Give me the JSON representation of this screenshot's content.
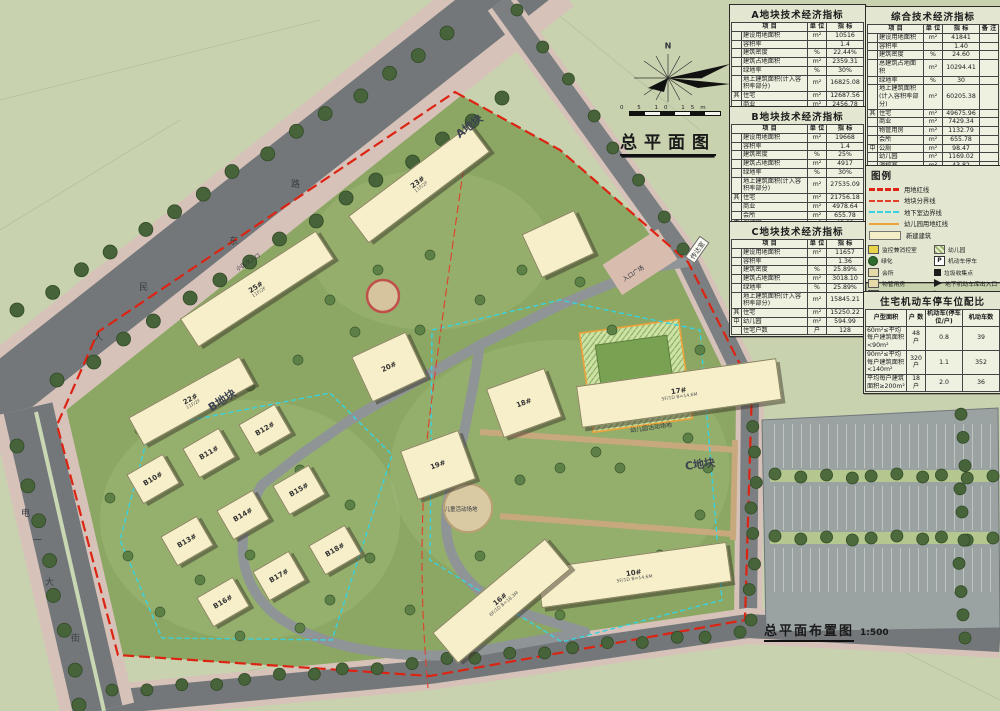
{
  "page": {
    "plan_title": "总平面图",
    "bottom_title": "总平面布置图",
    "bottom_scale": "1:500",
    "north_label": "N",
    "scale_bar_numbers": "0 5 10 15m"
  },
  "tables": {
    "a": {
      "title": "A地块技术经济指标",
      "header": [
        "项  目",
        "单 位",
        "指  标"
      ],
      "rows": [
        [
          "",
          "建设用地面积",
          "m²",
          "10516"
        ],
        [
          "",
          "容积率",
          "",
          "1.4"
        ],
        [
          "",
          "建筑密度",
          "%",
          "22.44%"
        ],
        [
          "",
          "建筑占地面积",
          "m²",
          "2359.31"
        ],
        [
          "",
          "绿地率",
          "%",
          "30%"
        ],
        [
          "",
          "地上建筑面积(计入容积率部分)",
          "m²",
          "16825.08"
        ],
        [
          "其",
          "住宅",
          "m²",
          "12687.56"
        ],
        [
          "",
          "商业",
          "m²",
          "2456.78"
        ],
        [
          "",
          "物管用房",
          "m²",
          "1132.79"
        ],
        [
          "中",
          "幼儿园",
          "m²",
          "574.03"
        ],
        [
          "",
          "住宅户数",
          "户",
          "108"
        ]
      ]
    },
    "b": {
      "title": "B地块技术经济指标",
      "header": [
        "项  目",
        "单 位",
        "指  标"
      ],
      "rows": [
        [
          "",
          "建设用地面积",
          "m²",
          "19668"
        ],
        [
          "",
          "容积率",
          "",
          "1.4"
        ],
        [
          "",
          "建筑密度",
          "%",
          "25%"
        ],
        [
          "",
          "建筑占地面积",
          "m²",
          "4917"
        ],
        [
          "",
          "绿地率",
          "%",
          "30%"
        ],
        [
          "",
          "地上建筑面积(计入容积率部分)",
          "m²",
          "27535.09"
        ],
        [
          "其",
          "住宅",
          "m²",
          "21756.18"
        ],
        [
          "",
          "商业",
          "m²",
          "4978.64"
        ],
        [
          "",
          "会所",
          "m²",
          "655.78"
        ],
        [
          "中",
          "消控室",
          "m²",
          "43.82"
        ],
        [
          "",
          "公厕",
          "m²",
          "98.67"
        ],
        [
          "",
          "住宅户数",
          "户",
          "150"
        ]
      ]
    },
    "c": {
      "title": "C地块技术经济指标",
      "header": [
        "项  目",
        "单 位",
        "指  标"
      ],
      "rows": [
        [
          "",
          "建设用地面积",
          "m²",
          "11657"
        ],
        [
          "",
          "容积率",
          "",
          "1.36"
        ],
        [
          "",
          "建筑密度",
          "%",
          "25.89%"
        ],
        [
          "",
          "建筑占地面积",
          "m²",
          "3018.10"
        ],
        [
          "",
          "绿地率",
          "%",
          "25.89%"
        ],
        [
          "",
          "地上建筑面积(计入容积率部分)",
          "m²",
          "15845.21"
        ],
        [
          "其",
          "住宅",
          "m²",
          "15250.22"
        ],
        [
          "中",
          "幼儿园",
          "m²",
          "594.99"
        ],
        [
          "",
          "住宅户数",
          "户",
          "128"
        ]
      ]
    },
    "comp": {
      "title": "综合技术经济指标",
      "header": [
        "项  目",
        "单 位",
        "指  标",
        "备 注"
      ],
      "rows": [
        [
          "",
          "建设用地面积",
          "m²",
          "41841",
          ""
        ],
        [
          "",
          "容积率",
          "",
          "1.40",
          ""
        ],
        [
          "",
          "建筑密度",
          "%",
          "24.60",
          ""
        ],
        [
          "",
          "总建筑占地面积",
          "m²",
          "10294.41",
          ""
        ],
        [
          "",
          "绿地率",
          "%",
          "30",
          ""
        ],
        [
          "",
          "地上建筑面积(计入容积率部分)",
          "m²",
          "60205.38",
          ""
        ],
        [
          "其",
          "住宅",
          "m²",
          "49675.96",
          ""
        ],
        [
          "",
          "商业",
          "m²",
          "7429.34",
          ""
        ],
        [
          "",
          "物管用房",
          "m²",
          "1132.79",
          ""
        ],
        [
          "",
          "会所",
          "m²",
          "655.78",
          ""
        ],
        [
          "中",
          "公厕",
          "m²",
          "98.47",
          ""
        ],
        [
          "",
          "幼儿园",
          "m²",
          "1169.02",
          ""
        ],
        [
          "",
          "消控室",
          "m²",
          "43.82",
          ""
        ],
        [
          "",
          "住宅户数",
          "户",
          "386",
          ""
        ],
        [
          "",
          "地下室(其中人防建筑面积10581.66m²)",
          "m²",
          "41853.32",
          ""
        ],
        [
          "",
          "机动车停车位",
          "个",
          "720",
          ""
        ],
        [
          "其",
          "地上停车位",
          "个",
          "30",
          ""
        ],
        [
          "中",
          "地下室停车位",
          "个",
          "690",
          ""
        ],
        [
          "",
          "非机动车面积",
          "m²",
          "1753",
          ""
        ]
      ]
    },
    "parking": {
      "title": "住宅机动车停车位配比",
      "header": [
        "户型面积",
        "户 数",
        "机动车(停车位/户)",
        "机动车数"
      ],
      "rows": [
        [
          "60m²≤平均每户建筑面积<90m²",
          "48 户",
          "0.8",
          "39"
        ],
        [
          "90m²≤平均每户建筑面积<140m²",
          "320 户",
          "1.1",
          "352"
        ],
        [
          "平均每户建筑面积≥200m²",
          "18 户",
          "2.0",
          "36"
        ]
      ]
    }
  },
  "legend": {
    "title": "图例",
    "lines": [
      [
        "red-bold",
        "用地红线"
      ],
      [
        "red-thin",
        "地块分界线"
      ],
      [
        "cyan",
        "地下室边界线"
      ],
      [
        "orange",
        "幼儿园用地红线"
      ],
      [
        "beige",
        "新建建筑"
      ]
    ],
    "col1": [
      [
        "box-yellow",
        "监控兼消控室"
      ],
      [
        "dot-green",
        "绿化"
      ],
      [
        "box-tan",
        "会所"
      ],
      [
        "box-tan",
        "物管用房"
      ],
      [
        "box-red",
        "日照站"
      ],
      [
        "arrow-red",
        "小区主、次入口"
      ],
      [
        "arrow-black",
        "建筑出入口"
      ]
    ],
    "col2": [
      [
        "box-hatch",
        "幼儿园"
      ],
      [
        "p-sign",
        "机动车停车"
      ],
      [
        "sq-black",
        "垃圾收集点"
      ],
      [
        "arrow-black",
        "地下机动车库出入口"
      ],
      [
        "arrow-open",
        "非机动车库入口"
      ],
      [
        "bolt",
        "变配电房"
      ]
    ]
  },
  "map": {
    "colors": {
      "boundary_red": "#dd2312",
      "basement_cyan": "#38d3e0",
      "kindergarten_orange": "#eda33b",
      "building_fill": "#f6efc9",
      "road_grey": "#73777a",
      "site_green": "#8ca663"
    },
    "road_names": [
      {
        "t": "人",
        "x": 94,
        "y": 330
      },
      {
        "t": "民",
        "x": 139,
        "y": 280
      },
      {
        "t": "东",
        "x": 229,
        "y": 234
      },
      {
        "t": "路",
        "x": 291,
        "y": 177
      },
      {
        "t": "电",
        "x": 21,
        "y": 506
      },
      {
        "t": "一",
        "x": 33,
        "y": 533
      },
      {
        "t": "大",
        "x": 45,
        "y": 575
      },
      {
        "t": "街",
        "x": 71,
        "y": 631
      }
    ],
    "labels": [
      {
        "t": "传达室",
        "x": 697,
        "y": 250,
        "r": -55,
        "s": 6.5,
        "bg": 1
      },
      {
        "t": "入口广场",
        "x": 633,
        "y": 273,
        "r": -33,
        "s": 6
      },
      {
        "t": "幼儿园活动场地",
        "x": 651,
        "y": 427,
        "r": -8,
        "s": 6
      },
      {
        "t": "C地块",
        "x": 700,
        "y": 464,
        "r": -8,
        "s": 11,
        "b": 1
      },
      {
        "t": "B地块",
        "x": 222,
        "y": 400,
        "r": -33,
        "s": 11,
        "b": 1
      },
      {
        "t": "A地块",
        "x": 469,
        "y": 126,
        "r": -38,
        "s": 11,
        "b": 1
      },
      {
        "t": "小区次入口",
        "x": 248,
        "y": 262,
        "r": -33,
        "s": 5.5
      },
      {
        "t": "儿童活动场地",
        "x": 461,
        "y": 509,
        "r": 0,
        "s": 5.5
      }
    ],
    "buildings": [
      {
        "label": "23#",
        "sub": "11F/2F",
        "x": 418,
        "y": 183,
        "w": 150,
        "h": 32,
        "rot": -37
      },
      {
        "label": "25#",
        "sub": "11F/2F",
        "x": 256,
        "y": 288,
        "w": 160,
        "h": 32,
        "rot": -33
      },
      {
        "label": "22#",
        "sub": "11F/2F",
        "x": 190,
        "y": 400,
        "w": 125,
        "h": 30,
        "rot": -29
      },
      {
        "label": "",
        "sub": "",
        "x": 557,
        "y": 243,
        "w": 56,
        "h": 46,
        "rot": -25
      },
      {
        "label": "20#",
        "sub": "",
        "x": 388,
        "y": 366,
        "w": 58,
        "h": 48,
        "rot": -25
      },
      {
        "label": "18#",
        "sub": "",
        "x": 523,
        "y": 402,
        "w": 60,
        "h": 50,
        "rot": -20
      },
      {
        "label": "19#",
        "sub": "",
        "x": 437,
        "y": 464,
        "w": 60,
        "h": 50,
        "rot": -20
      },
      {
        "label": "17#",
        "sub": "5F/1D B=14.6M",
        "x": 678,
        "y": 392,
        "w": 200,
        "h": 40,
        "rot": -8
      },
      {
        "label": "10#",
        "sub": "5F/1D B=14.6M",
        "x": 633,
        "y": 574,
        "w": 190,
        "h": 38,
        "rot": -8
      },
      {
        "label": "16#",
        "sub": "6F/1D B=18.3M",
        "x": 500,
        "y": 600,
        "w": 145,
        "h": 38,
        "rot": -40
      },
      {
        "label": "B12#",
        "sub": "",
        "x": 264,
        "y": 428,
        "w": 40,
        "h": 32,
        "rot": -30
      },
      {
        "label": "B11#",
        "sub": "",
        "x": 208,
        "y": 452,
        "w": 40,
        "h": 32,
        "rot": -30
      },
      {
        "label": "B10#",
        "sub": "",
        "x": 152,
        "y": 478,
        "w": 40,
        "h": 32,
        "rot": -30
      },
      {
        "label": "B15#",
        "sub": "",
        "x": 298,
        "y": 489,
        "w": 40,
        "h": 32,
        "rot": -30
      },
      {
        "label": "B14#",
        "sub": "",
        "x": 242,
        "y": 514,
        "w": 40,
        "h": 32,
        "rot": -30
      },
      {
        "label": "B13#",
        "sub": "",
        "x": 186,
        "y": 540,
        "w": 40,
        "h": 32,
        "rot": -30
      },
      {
        "label": "B18#",
        "sub": "",
        "x": 334,
        "y": 549,
        "w": 40,
        "h": 32,
        "rot": -30
      },
      {
        "label": "B17#",
        "sub": "",
        "x": 278,
        "y": 575,
        "w": 40,
        "h": 32,
        "rot": -30
      },
      {
        "label": "B16#",
        "sub": "",
        "x": 222,
        "y": 601,
        "w": 40,
        "h": 32,
        "rot": -30
      }
    ]
  }
}
